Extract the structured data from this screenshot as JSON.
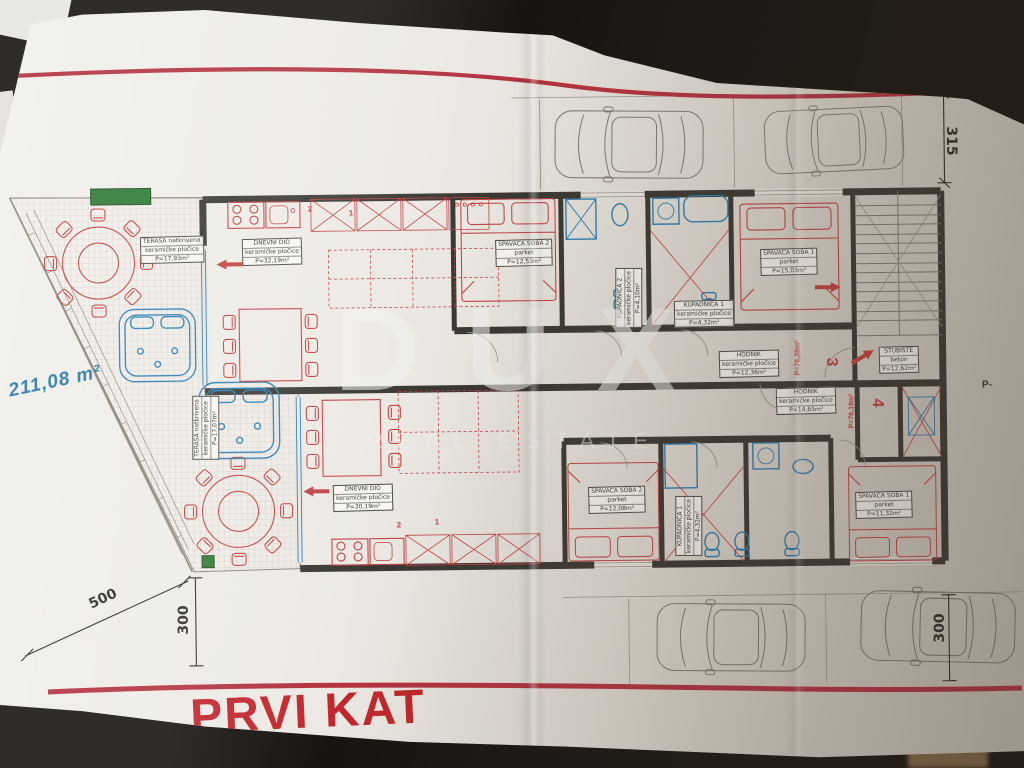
{
  "colors": {
    "paper": "#eae7e1",
    "red_line": "#b23240",
    "title_red": "#c1272d",
    "plan_red": "#c24343",
    "plan_blue": "#2d7fb3",
    "wall": "#3a3833",
    "green": "#2e7a34",
    "blue_text": "#2a7ba8",
    "gray_line": "#807c72",
    "dim_text": "#2e2c28"
  },
  "title": "PRVI KAT",
  "watermark": {
    "brand": "DUX",
    "tagline": "REAL ESTATE"
  },
  "site": {
    "area": "211,08 m²",
    "p_label": "P-",
    "dims": {
      "diagonal": "500",
      "left": "300",
      "top_right": "315",
      "bottom_right": "300"
    }
  },
  "apartments": {
    "a3": {
      "number": "3",
      "area": "P=76,28m²"
    },
    "a4": {
      "number": "4",
      "area": "P=76,19m²"
    }
  },
  "marks": {
    "upper_left": "2",
    "upper_right": "1",
    "lower_left": "2",
    "lower_right": "1"
  },
  "rooms": {
    "terasa_upper": {
      "name": "TERASA natkrivena",
      "sub": "keramičke pločice",
      "area": "P=17,93m²"
    },
    "dnevni_upper": {
      "name": "DNEVNI DIO",
      "sub": "keramičke pločice",
      "area": "P=32,19m²"
    },
    "soba2_upper": {
      "name": "SPAVAĆA SOBA 2",
      "sub": "parket",
      "area": "P=12,53m²"
    },
    "kupaonica2_upper": {
      "name": "KUPAONICA 2",
      "sub": "keramičke pločice",
      "area": "P=4,10m²"
    },
    "kupaonica1_upper": {
      "name": "KUPAONICA 1",
      "sub": "keramičke pločice",
      "area": "P=4,32m²"
    },
    "soba1_upper": {
      "name": "SPAVAĆA SOBA 1",
      "sub": "parket",
      "area": "P=15,03m²"
    },
    "hodnik_upper": {
      "name": "HODNIK",
      "sub": "keramičke pločice",
      "area": "P=12,36m²"
    },
    "stubiste": {
      "name": "STUBIŠTE",
      "sub": "beton",
      "area": "P=12,62m²"
    },
    "hodnik_lower": {
      "name": "HODNIK",
      "sub": "keramičke pločice",
      "area": "P=14,65m²"
    },
    "terasa_lower": {
      "name": "TERASA natkrivena",
      "sub": "keramičke pločice",
      "area": "P=17,07m²"
    },
    "dnevni_lower": {
      "name": "DNEVNI DIO",
      "sub": "keramičke pločice",
      "area": "P=30,19m²"
    },
    "soba2_lower": {
      "name": "SPAVAĆA SOBA 2",
      "sub": "parket",
      "area": "P=12,08m²"
    },
    "kupaonica1_lower": {
      "name": "KUPAONICA 1",
      "sub": "keramičke pločice",
      "area": "P=4,32m²"
    },
    "soba1_lower": {
      "name": "SPAVAĆA SOBA 1",
      "sub": "parket",
      "area": "P=11,32m²"
    }
  }
}
